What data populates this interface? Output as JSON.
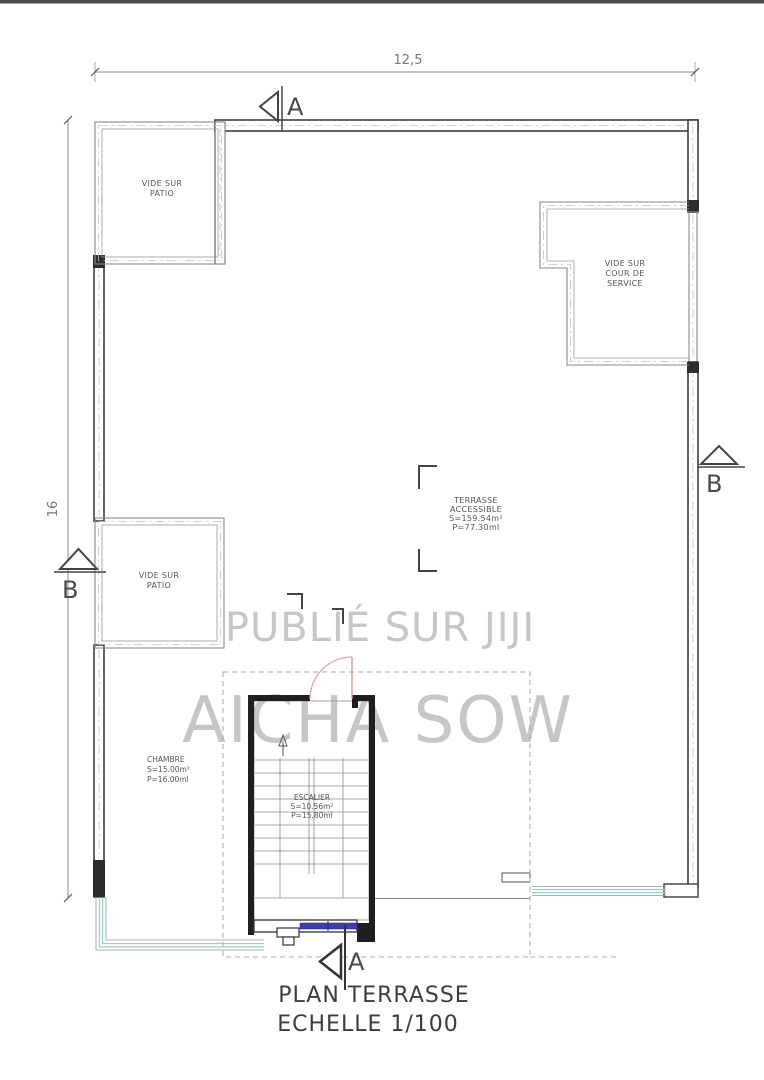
{
  "title": {
    "line1": "PLAN TERRASSE",
    "line2": "ECHELLE 1/100"
  },
  "dimensions": {
    "top_width": "12,5",
    "left_height": "16"
  },
  "section_markers": {
    "top": "A",
    "bottom": "A",
    "left": "B",
    "right": "B"
  },
  "watermark": {
    "line1": "PUBLIÉ SUR JIJI",
    "line2": "AICHA SOW"
  },
  "rooms": {
    "patio_top": {
      "label": [
        "VIDE SUR",
        "PATIO"
      ]
    },
    "patio_mid": {
      "label": [
        "VIDE SUR",
        "PATIO"
      ]
    },
    "cour": {
      "label": [
        "VIDE SUR",
        "COUR DE",
        "SERVICE"
      ]
    },
    "terrasse": {
      "label": [
        "TERRASSE",
        "ACCESSIBLE",
        "S=159.54m²",
        "P=77.30ml"
      ]
    },
    "chambre": {
      "label": [
        "CHAMBRE",
        "S=15.00m²",
        "P=16.00ml"
      ]
    },
    "escalier": {
      "label": [
        "ESCALIER",
        "S=10.56m²",
        "P=15.80ml"
      ]
    }
  },
  "colors": {
    "wall": "#3f3f3f",
    "window_teal": "#8fd3cd",
    "window_blue": "#3d3db5",
    "door_arc": "#dcaaa0",
    "watermark": "#c6c6c6",
    "text": "#555555"
  }
}
